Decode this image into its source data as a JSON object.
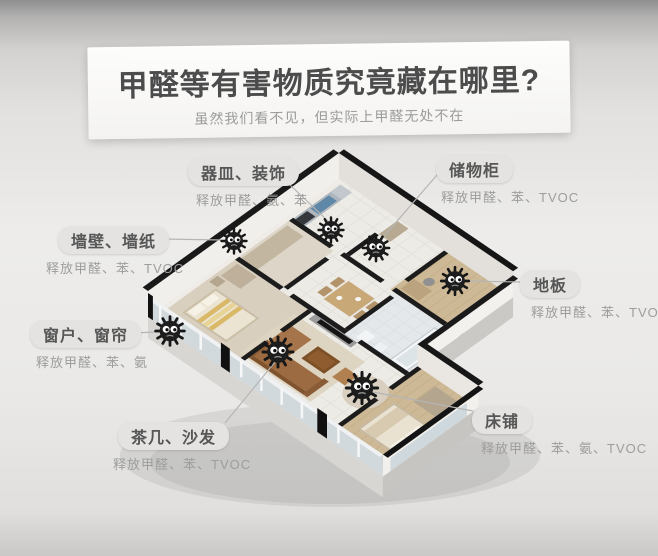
{
  "header": {
    "title": "甲醛等有害物质究竟藏在哪里?",
    "subtitle": "虽然我们看不见，但实际上甲醛无处不在"
  },
  "labels": [
    {
      "id": "utensils-decor",
      "name": "器皿、装饰",
      "emits": "释放甲醛、氨、苯"
    },
    {
      "id": "storage-cabinet",
      "name": "储物柜",
      "emits": "释放甲醛、苯、TVOC"
    },
    {
      "id": "walls-wallpaper",
      "name": "墙壁、墙纸",
      "emits": "释放甲醛、苯、TVOC"
    },
    {
      "id": "floor",
      "name": "地板",
      "emits": "释放甲醛、苯、TVOC"
    },
    {
      "id": "windows-curtains",
      "name": "窗户、窗帘",
      "emits": "释放甲醛、苯、氨"
    },
    {
      "id": "tea-table-sofa",
      "name": "茶几、沙发",
      "emits": "释放甲醛、苯、TVOC"
    },
    {
      "id": "bed",
      "name": "床铺",
      "emits": "释放甲醛、苯、氨、TVOC"
    }
  ],
  "colors": {
    "pill_background": "#e4e3e1",
    "pill_text": "#565656",
    "sub_text": "#9d9d9d",
    "wall_top": "#181818",
    "monster_body": "#1d1d1d",
    "background": "#eae9e7"
  }
}
